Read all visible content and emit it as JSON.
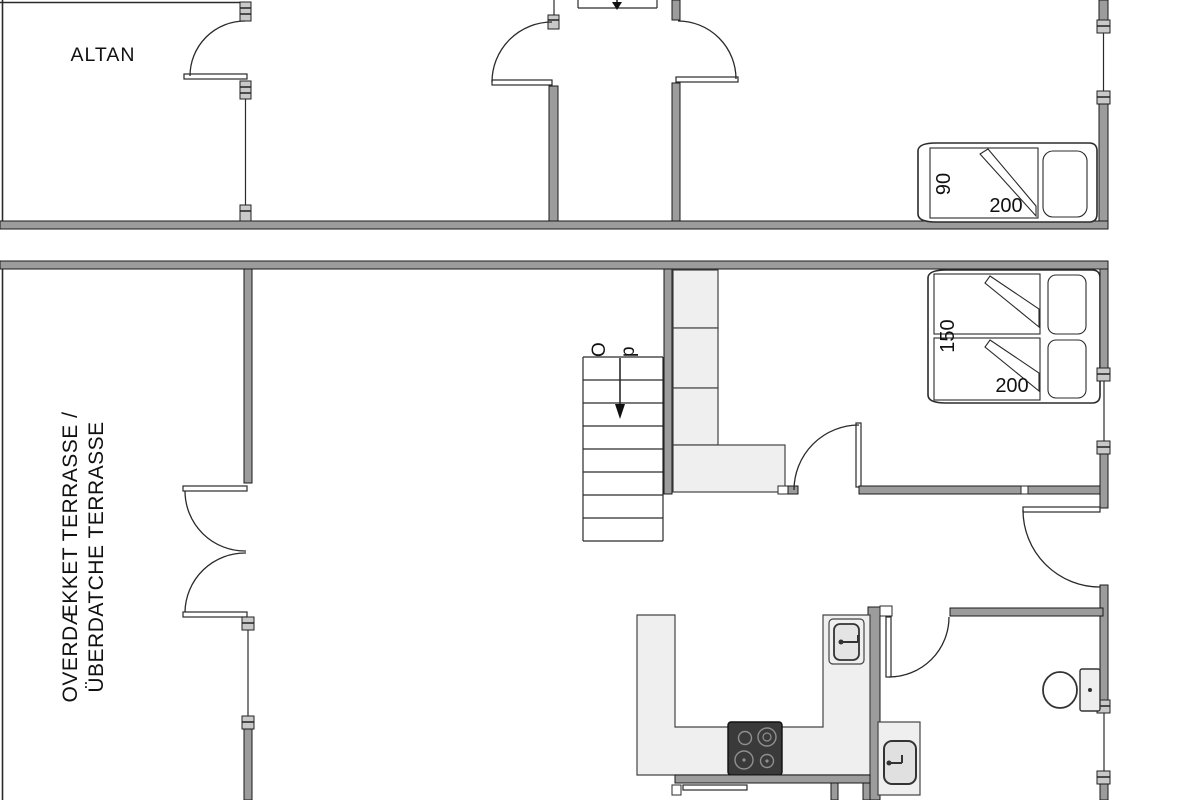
{
  "floor_plan": {
    "colors": {
      "background": "#ffffff",
      "wall_fill": "#9c9c9c",
      "wall_outline": "#1a1a1a",
      "thin_line": "#2a2a2a",
      "furniture_fill": "#efefef",
      "cooktop_fill": "#3a3a3a"
    },
    "upper_level": {
      "balcony_label": "ALTAN",
      "single_bed": {
        "width_cm": "90",
        "length_cm": "200"
      }
    },
    "lower_level": {
      "covered_terrace_label_line1": "OVERDÆKKET TERRASSE /",
      "covered_terrace_label_line2": "ÜBERDATCHE TERRASSE",
      "stairs_direction_label": "Op",
      "double_bed": {
        "width_cm": "150",
        "length_cm": "200"
      }
    }
  }
}
